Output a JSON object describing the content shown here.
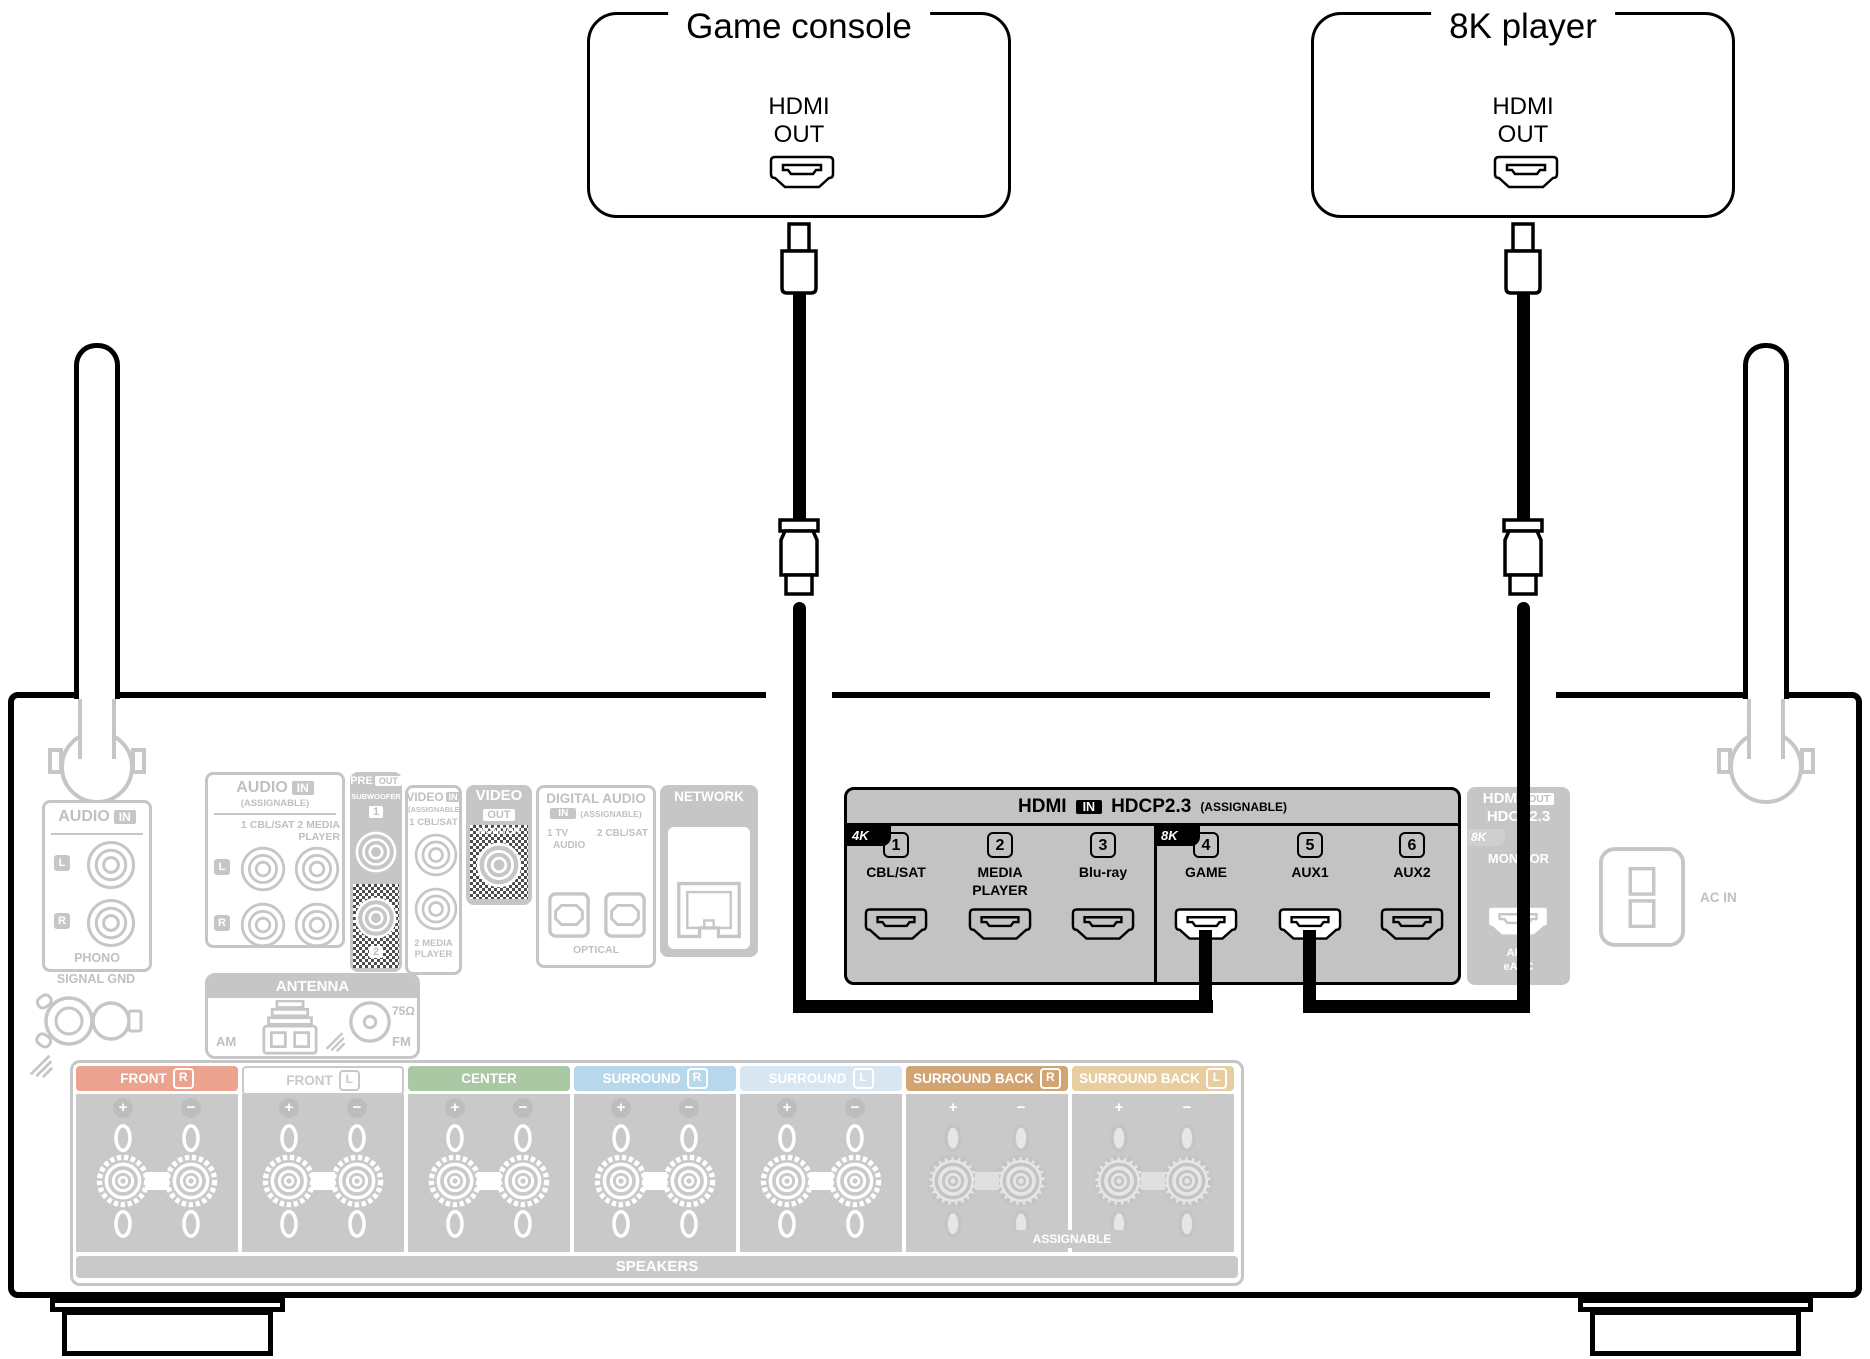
{
  "devices": {
    "game_console": {
      "title": "Game console",
      "port_line1": "HDMI",
      "port_line2": "OUT"
    },
    "player_8k": {
      "title": "8K player",
      "port_line1": "HDMI",
      "port_line2": "OUT"
    }
  },
  "receiver": {
    "phono": {
      "header": "AUDIO",
      "header_badge": "IN",
      "left": "L",
      "right": "R",
      "label": "PHONO"
    },
    "signal_gnd_label": "SIGNAL GND",
    "audio_in": {
      "header": "AUDIO",
      "header_badge": "IN",
      "assignable": "(ASSIGNABLE)",
      "inputs_line1": "1 CBL/SAT 2 MEDIA",
      "inputs_line2": "PLAYER",
      "left": "L",
      "right": "R"
    },
    "pre_out": {
      "title": "PRE",
      "title_badge": "OUT",
      "subtitle": "SUBWOOFER",
      "jack1": "1",
      "jack2": "2"
    },
    "video_in": {
      "header": "VIDEO",
      "header_badge": "IN",
      "assignable": "(ASSIGNABLE)",
      "input1": "1 CBL/SAT",
      "input2_line1": "2 MEDIA",
      "input2_line2": "PLAYER"
    },
    "video_out": {
      "header": "VIDEO",
      "header_badge": "OUT",
      "jack": "MONITOR"
    },
    "digital_audio": {
      "header": "DIGITAL AUDIO",
      "header_badge": "IN",
      "assignable": "(ASSIGNABLE)",
      "input1_line1": "1  TV",
      "input1_line2": "AUDIO",
      "input2": "2 CBL/SAT",
      "footer": "OPTICAL"
    },
    "network_label": "NETWORK",
    "hdmi_in": {
      "header_title": "HDMI",
      "header_badge": "IN",
      "header_hdcp": "HDCP2.3",
      "header_assignable": "(ASSIGNABLE)",
      "badge_4k": "4K",
      "badge_8k": "8K",
      "ports": [
        {
          "num": "1",
          "label": "CBL/SAT",
          "connected": false
        },
        {
          "num": "2",
          "label": "MEDIA",
          "label2": "PLAYER",
          "connected": false
        },
        {
          "num": "3",
          "label": "Blu-ray",
          "connected": false
        },
        {
          "num": "4",
          "label": "GAME",
          "connected": true
        },
        {
          "num": "5",
          "label": "AUX1",
          "connected": true
        },
        {
          "num": "6",
          "label": "AUX2",
          "connected": false
        }
      ]
    },
    "hdmi_out": {
      "title": "HDMI",
      "badge": "OUT",
      "hdcp": "HDCP2.3",
      "badge_8k": "8K",
      "monitor": "MONITOR",
      "arc": "ARC",
      "earc": "eARC"
    },
    "ac_in_label": "AC IN",
    "antenna": {
      "header": "ANTENNA",
      "am": "AM",
      "fm": "FM",
      "ohm": "75Ω"
    },
    "speakers": {
      "title": "SPEAKERS",
      "assignable": "ASSIGNABLE",
      "channels": [
        {
          "name": "FRONT",
          "side": "R",
          "bar_color": "#eba28f",
          "text_color": "#ffffff",
          "checkered": false
        },
        {
          "name": "FRONT",
          "side": "L",
          "bar_color": "#ffffff",
          "text_color": "#c9c9c9",
          "checkered": false
        },
        {
          "name": "CENTER",
          "side": "",
          "bar_color": "#a9c8a3",
          "text_color": "#ffffff",
          "checkered": false
        },
        {
          "name": "SURROUND",
          "side": "R",
          "bar_color": "#b7d8ea",
          "text_color": "#ffffff",
          "checkered": false
        },
        {
          "name": "SURROUND",
          "side": "L",
          "bar_color": "#d7e6f1",
          "text_color": "#ffffff",
          "checkered": false
        },
        {
          "name": "SURROUND BACK",
          "side": "R",
          "bar_color": "#d2a474",
          "text_color": "#ffffff",
          "checkered": true
        },
        {
          "name": "SURROUND BACK",
          "side": "L",
          "bar_color": "#e8cda0",
          "text_color": "#ffffff",
          "checkered": true
        }
      ]
    }
  },
  "colors": {
    "grayed": "#c6c6c6",
    "hdmi_section_bg": "#c3c3c3",
    "cable": "#000000",
    "highlight_text": "#000000"
  }
}
